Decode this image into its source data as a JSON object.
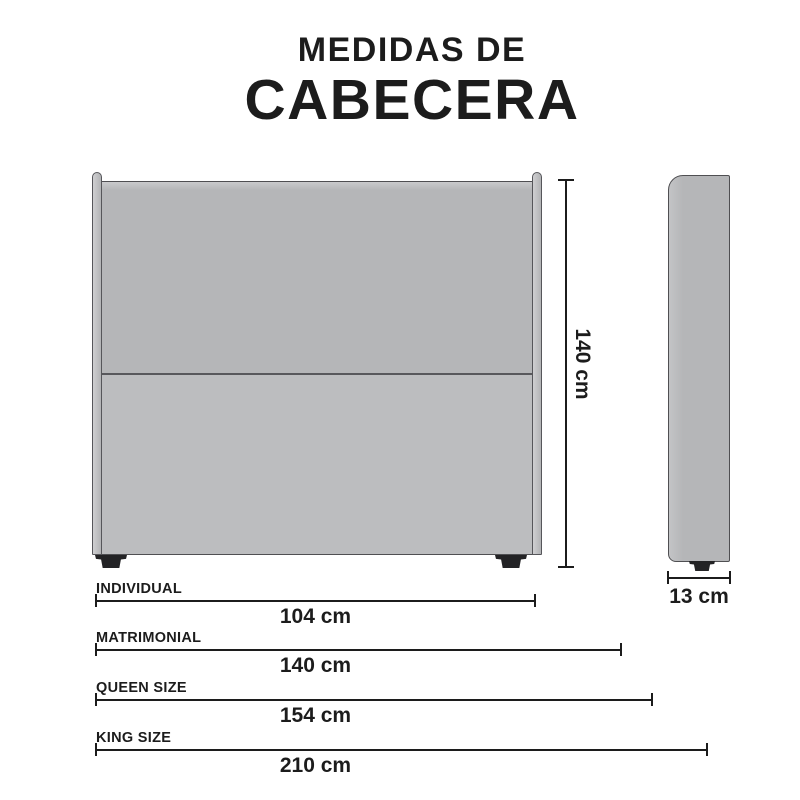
{
  "title": {
    "line1": "MEDIDAS DE",
    "line2": "CABECERA"
  },
  "diagram": {
    "front_view": "headboard front view",
    "side_view": "headboard side view",
    "height_label": "140 cm",
    "depth_label": "13 cm"
  },
  "sizes": [
    {
      "label": "INDIVIDUAL",
      "value": "104 cm"
    },
    {
      "label": "MATRIMONIAL",
      "value": "140 cm"
    },
    {
      "label": "QUEEN SIZE",
      "value": "154 cm"
    },
    {
      "label": "KING SIZE",
      "value": "210 cm"
    }
  ],
  "colors": {
    "text": "#1c1c1c",
    "panel_gray": "#b5b6b8",
    "panel_gray_light": "#bcbdbf",
    "outline": "#4f4f52",
    "foot_black": "#232325",
    "dimension_line": "#1c1c1c"
  }
}
